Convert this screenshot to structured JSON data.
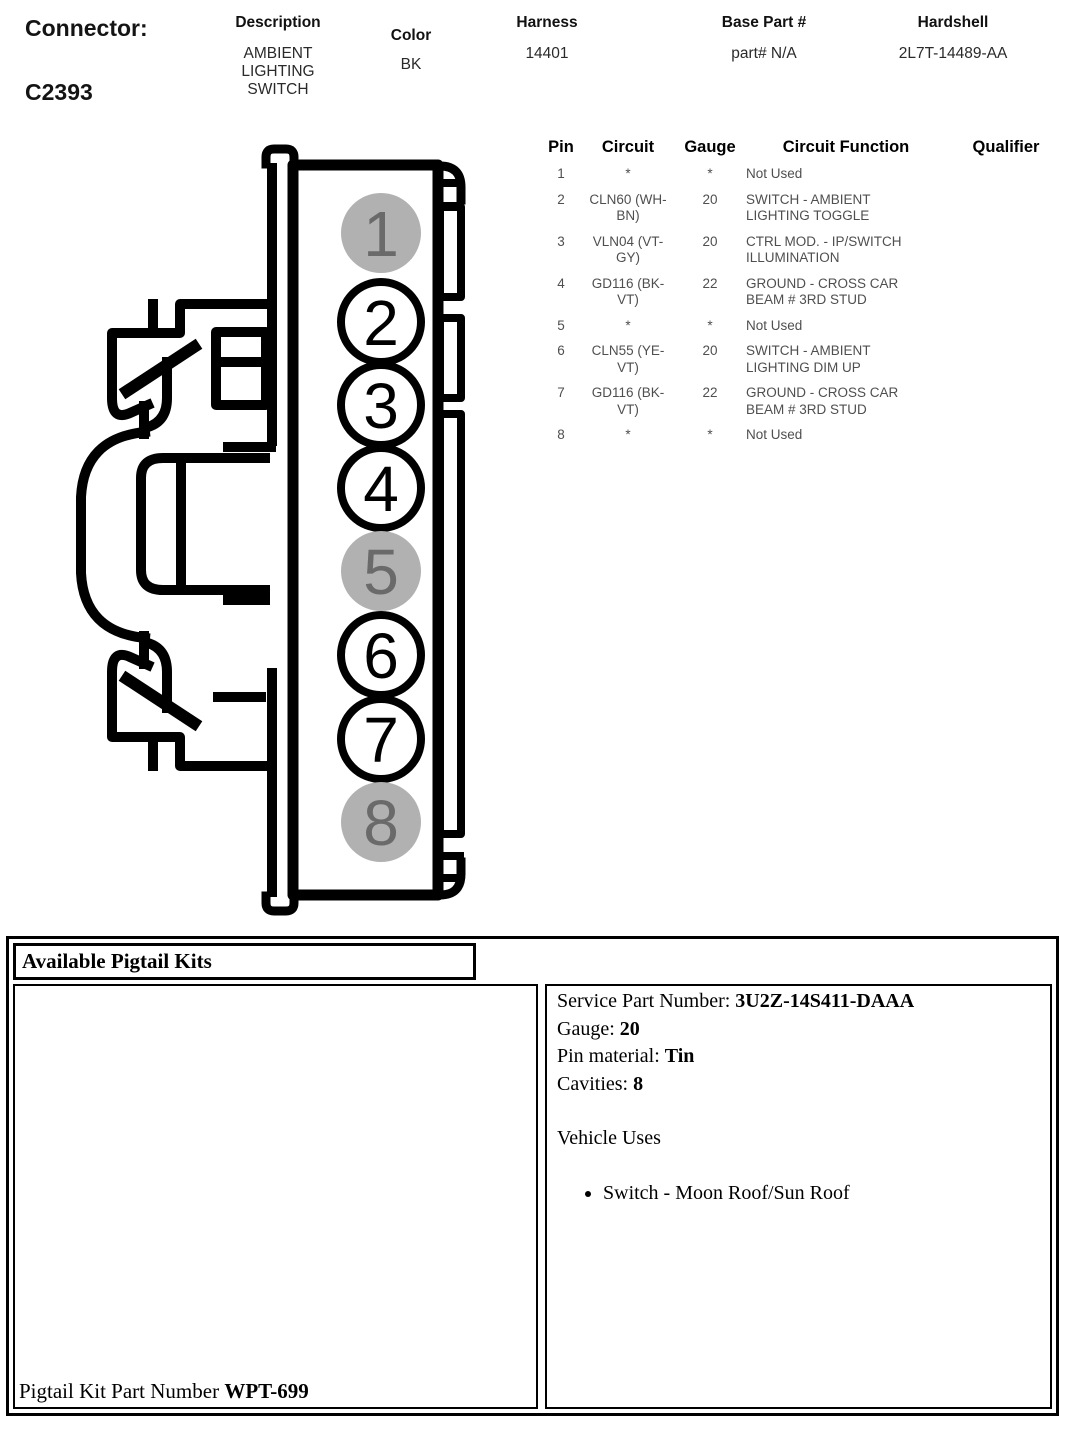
{
  "header": {
    "connector_label": "Connector:",
    "connector_id": "C2393",
    "columns": [
      {
        "label": "Description",
        "value": "AMBIENT LIGHTING SWITCH"
      },
      {
        "label": "Color",
        "value": "BK"
      },
      {
        "label": "Harness",
        "value": "14401"
      },
      {
        "label": "Base Part #",
        "value": "part# N/A"
      },
      {
        "label": "Hardshell",
        "value": "2L7T-14489-AA"
      }
    ]
  },
  "pin_table": {
    "headers": [
      "Pin",
      "Circuit",
      "Gauge",
      "Circuit Function",
      "Qualifier"
    ],
    "rows": [
      {
        "pin": "1",
        "circuit": "*",
        "gauge": "*",
        "function": "Not Used",
        "qualifier": ""
      },
      {
        "pin": "2",
        "circuit": "CLN60 (WH-BN)",
        "gauge": "20",
        "function": "SWITCH - AMBIENT LIGHTING TOGGLE",
        "qualifier": ""
      },
      {
        "pin": "3",
        "circuit": "VLN04 (VT-GY)",
        "gauge": "20",
        "function": "CTRL MOD. - IP/SWITCH ILLUMINATION",
        "qualifier": ""
      },
      {
        "pin": "4",
        "circuit": "GD116 (BK-VT)",
        "gauge": "22",
        "function": "GROUND - CROSS CAR BEAM # 3RD STUD",
        "qualifier": ""
      },
      {
        "pin": "5",
        "circuit": "*",
        "gauge": "*",
        "function": "Not Used",
        "qualifier": ""
      },
      {
        "pin": "6",
        "circuit": "CLN55 (YE-VT)",
        "gauge": "20",
        "function": "SWITCH - AMBIENT LIGHTING DIM UP",
        "qualifier": ""
      },
      {
        "pin": "7",
        "circuit": "GD116 (BK-VT)",
        "gauge": "22",
        "function": "GROUND - CROSS CAR BEAM # 3RD STUD",
        "qualifier": ""
      },
      {
        "pin": "8",
        "circuit": "*",
        "gauge": "*",
        "function": "Not Used",
        "qualifier": ""
      }
    ]
  },
  "connector_drawing": {
    "pins": [
      {
        "number": "1",
        "used": false
      },
      {
        "number": "2",
        "used": true
      },
      {
        "number": "3",
        "used": true
      },
      {
        "number": "4",
        "used": true
      },
      {
        "number": "5",
        "used": false
      },
      {
        "number": "6",
        "used": true
      },
      {
        "number": "7",
        "used": true
      },
      {
        "number": "8",
        "used": false
      }
    ],
    "colors": {
      "line": "#000000",
      "unused_fill": "#b1b1b1",
      "unused_digit": "#6a6a6a",
      "used_fill": "#ffffff"
    }
  },
  "pigtail": {
    "title": "Available Pigtail Kits",
    "service_part_label": "Service Part Number:",
    "service_part_number": "3U2Z-14S411-DAAA",
    "gauge_label": "Gauge:",
    "gauge": "20",
    "pin_material_label": "Pin material:",
    "pin_material": "Tin",
    "cavities_label": "Cavities:",
    "cavities": "8",
    "vehicle_uses_label": "Vehicle Uses",
    "vehicle_uses": [
      "Switch - Moon Roof/Sun Roof"
    ],
    "kit_label": "Pigtail Kit Part Number",
    "kit_number": "WPT-699"
  }
}
